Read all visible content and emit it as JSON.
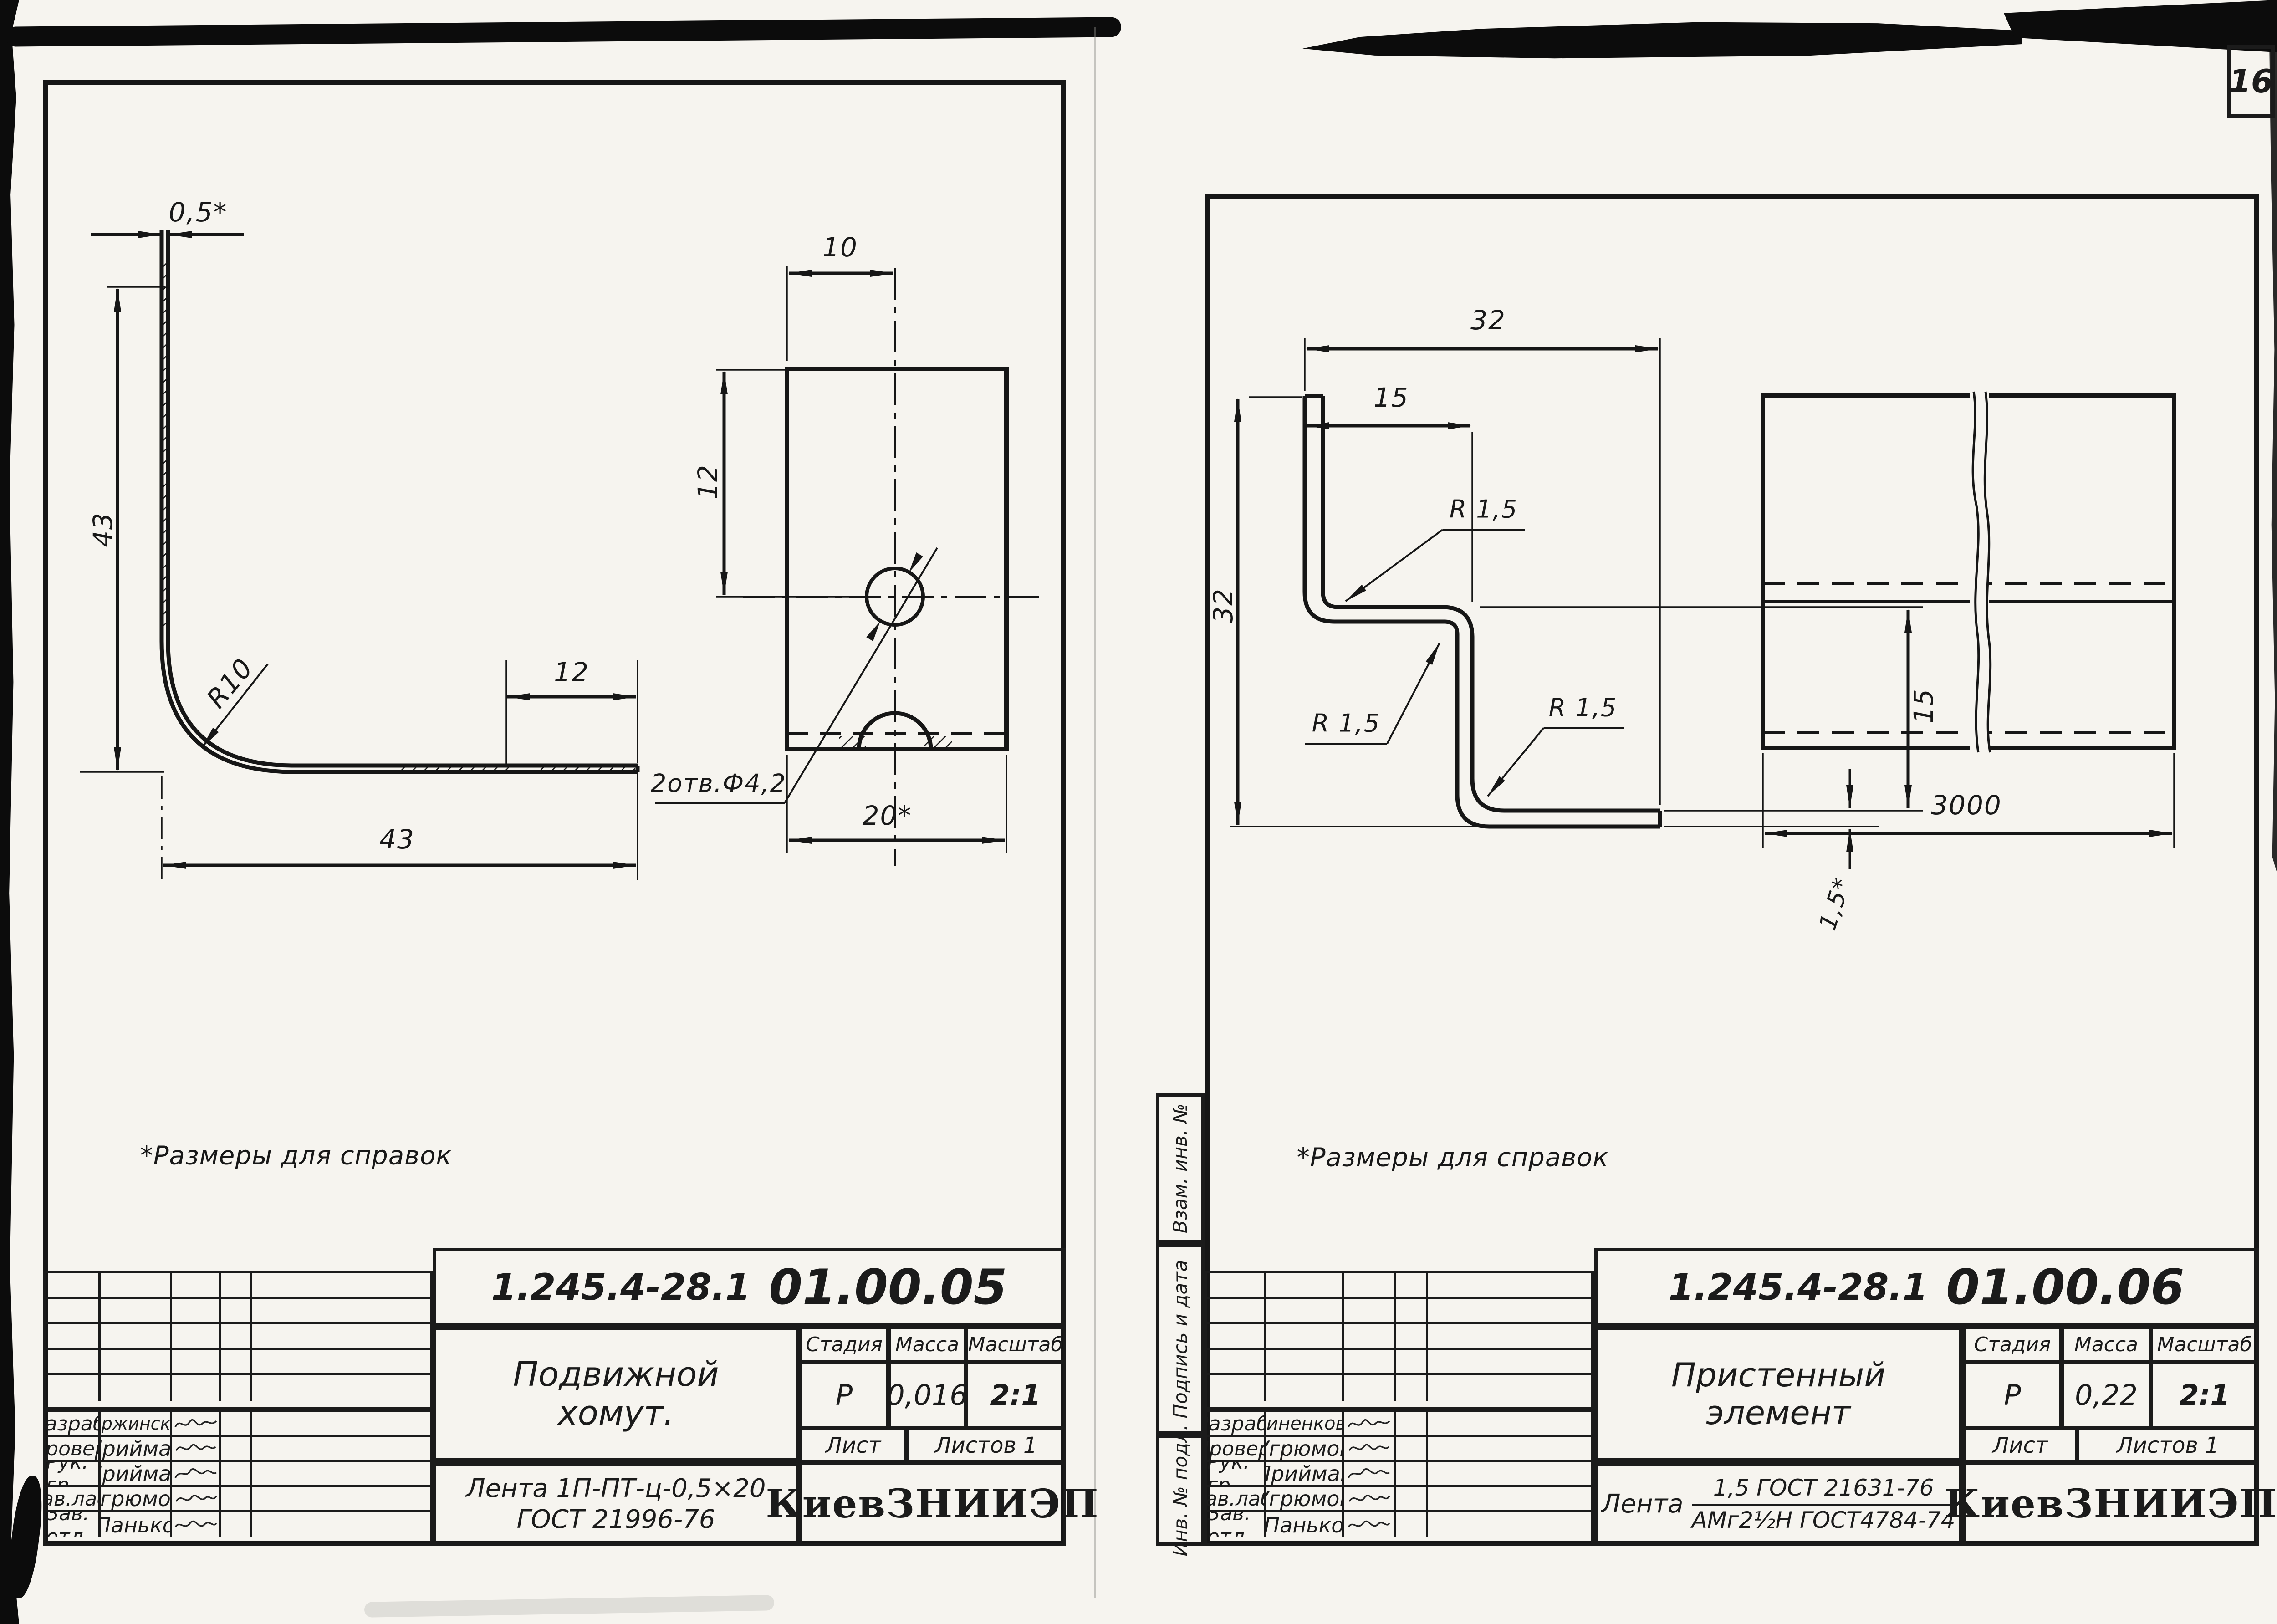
{
  "page_number": "16",
  "left_sheet": {
    "note": "*Размеры для справок",
    "drawing": {
      "dim_thickness": "0,5*",
      "dim_height": "43",
      "dim_radius": "R10",
      "dim_tab": "12",
      "dim_length": "43",
      "dim_hole_offset_x": "10",
      "dim_hole_offset_y": "12",
      "hole_callout": "2отв.Ф4,2",
      "dim_width": "20*"
    },
    "title_block": {
      "doc_number": "1.245.4-28.1",
      "doc_code": "01.00.05",
      "product_name_line1": "Подвижной",
      "product_name_line2": "хомут.",
      "material_line1": "Лента 1П-ПТ-ц-0,5×20",
      "material_line2": "ГОСТ 21996-76",
      "stage_label": "Стадия",
      "mass_label": "Масса",
      "scale_label": "Масштаб",
      "stage": "Р",
      "mass": "0,016",
      "scale": "2:1",
      "sheet_label": "Лист",
      "sheets_label": "Листов 1",
      "organization": "КиевЗНИИЭП",
      "signatures": [
        {
          "role": "Разраб.",
          "name": "Вержинская"
        },
        {
          "role": "Провер.",
          "name": "Приймак"
        },
        {
          "role": "Рук. гр.",
          "name": "Приймак"
        },
        {
          "role": "Зав.лаб.",
          "name": "Угрюмов"
        },
        {
          "role": "Зав. отд",
          "name": "Панько"
        }
      ]
    }
  },
  "right_sheet": {
    "note": "*Размеры для справок",
    "drawing": {
      "dim_width_total": "32",
      "dim_width_top": "15",
      "dim_height": "32",
      "dim_r1": "R 1,5",
      "dim_r2": "R 1,5",
      "dim_r3": "R 1,5",
      "dim_leg": "15",
      "dim_thickness": "1,5*",
      "dim_length": "3000"
    },
    "margin_labels": [
      "Взам. инв. №",
      "Подпись и дата",
      "Инв. № подл."
    ],
    "title_block": {
      "doc_number": "1.245.4-28.1",
      "doc_code": "01.00.06",
      "product_name_line1": "Пристенный",
      "product_name_line2": "элемент",
      "material_prefix": "Лента",
      "material_numerator": "1,5  ГОСТ 21631-76",
      "material_denominator": "АМг2½Н ГОСТ4784-74",
      "stage_label": "Стадия",
      "mass_label": "Масса",
      "scale_label": "Масштаб",
      "stage": "Р",
      "mass": "0,22",
      "scale": "2:1",
      "sheet_label": "Лист",
      "sheets_label": "Листов 1",
      "organization": "КиевЗНИИЭП",
      "signatures": [
        {
          "role": "Разраб.",
          "name": "Миненкова"
        },
        {
          "role": "Провер.",
          "name": "Угрюмов"
        },
        {
          "role": "Рук. гр.",
          "name": "Приймак"
        },
        {
          "role": "Зав.лаб.",
          "name": "Угрюмов"
        },
        {
          "role": "Зав. отд",
          "name": "Панько"
        }
      ]
    }
  }
}
